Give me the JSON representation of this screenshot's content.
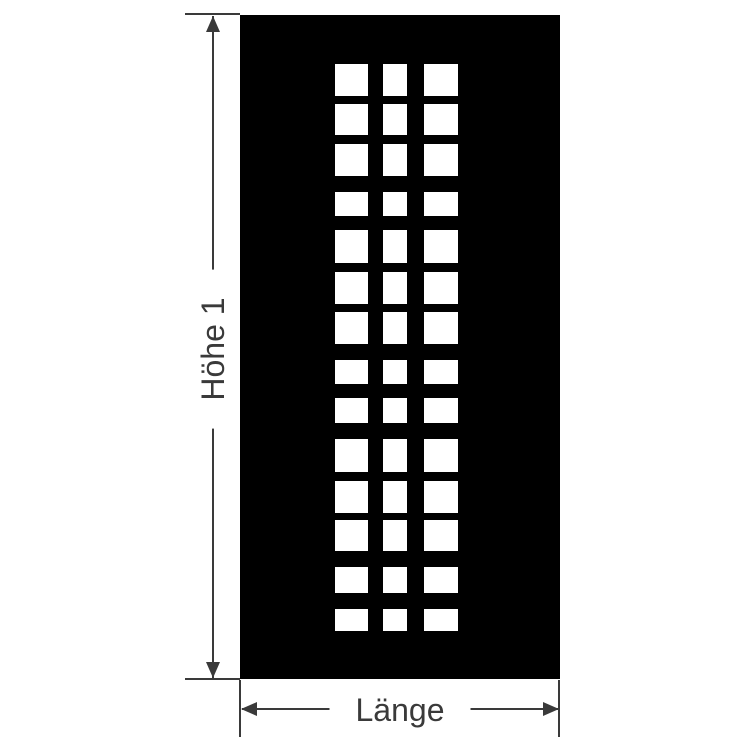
{
  "diagram": {
    "type": "dimension-drawing",
    "colors": {
      "background": "#ffffff",
      "panel": "#000000",
      "cutout": "#ffffff",
      "line": "#3a3a3a",
      "text": "#3a3a3a"
    },
    "panel": {
      "x": 240,
      "y": 15,
      "width": 320,
      "height": 664,
      "columns": [
        {
          "x": 95,
          "w": 33
        },
        {
          "x": 143,
          "w": 24
        },
        {
          "x": 184,
          "w": 34
        }
      ],
      "rows": [
        {
          "y": 49,
          "h": 32
        },
        {
          "y": 89,
          "h": 31
        },
        {
          "y": 129,
          "h": 32
        },
        {
          "y": 177,
          "h": 24
        },
        {
          "y": 215,
          "h": 33
        },
        {
          "y": 257,
          "h": 32
        },
        {
          "y": 297,
          "h": 32
        },
        {
          "y": 345,
          "h": 24
        },
        {
          "y": 383,
          "h": 25
        },
        {
          "y": 424,
          "h": 33
        },
        {
          "y": 466,
          "h": 32
        },
        {
          "y": 505,
          "h": 31
        },
        {
          "y": 552,
          "h": 26
        },
        {
          "y": 594,
          "h": 22
        }
      ]
    },
    "dimensions": {
      "height": {
        "label": "Höhe 1"
      },
      "length": {
        "label": "Länge"
      }
    }
  }
}
